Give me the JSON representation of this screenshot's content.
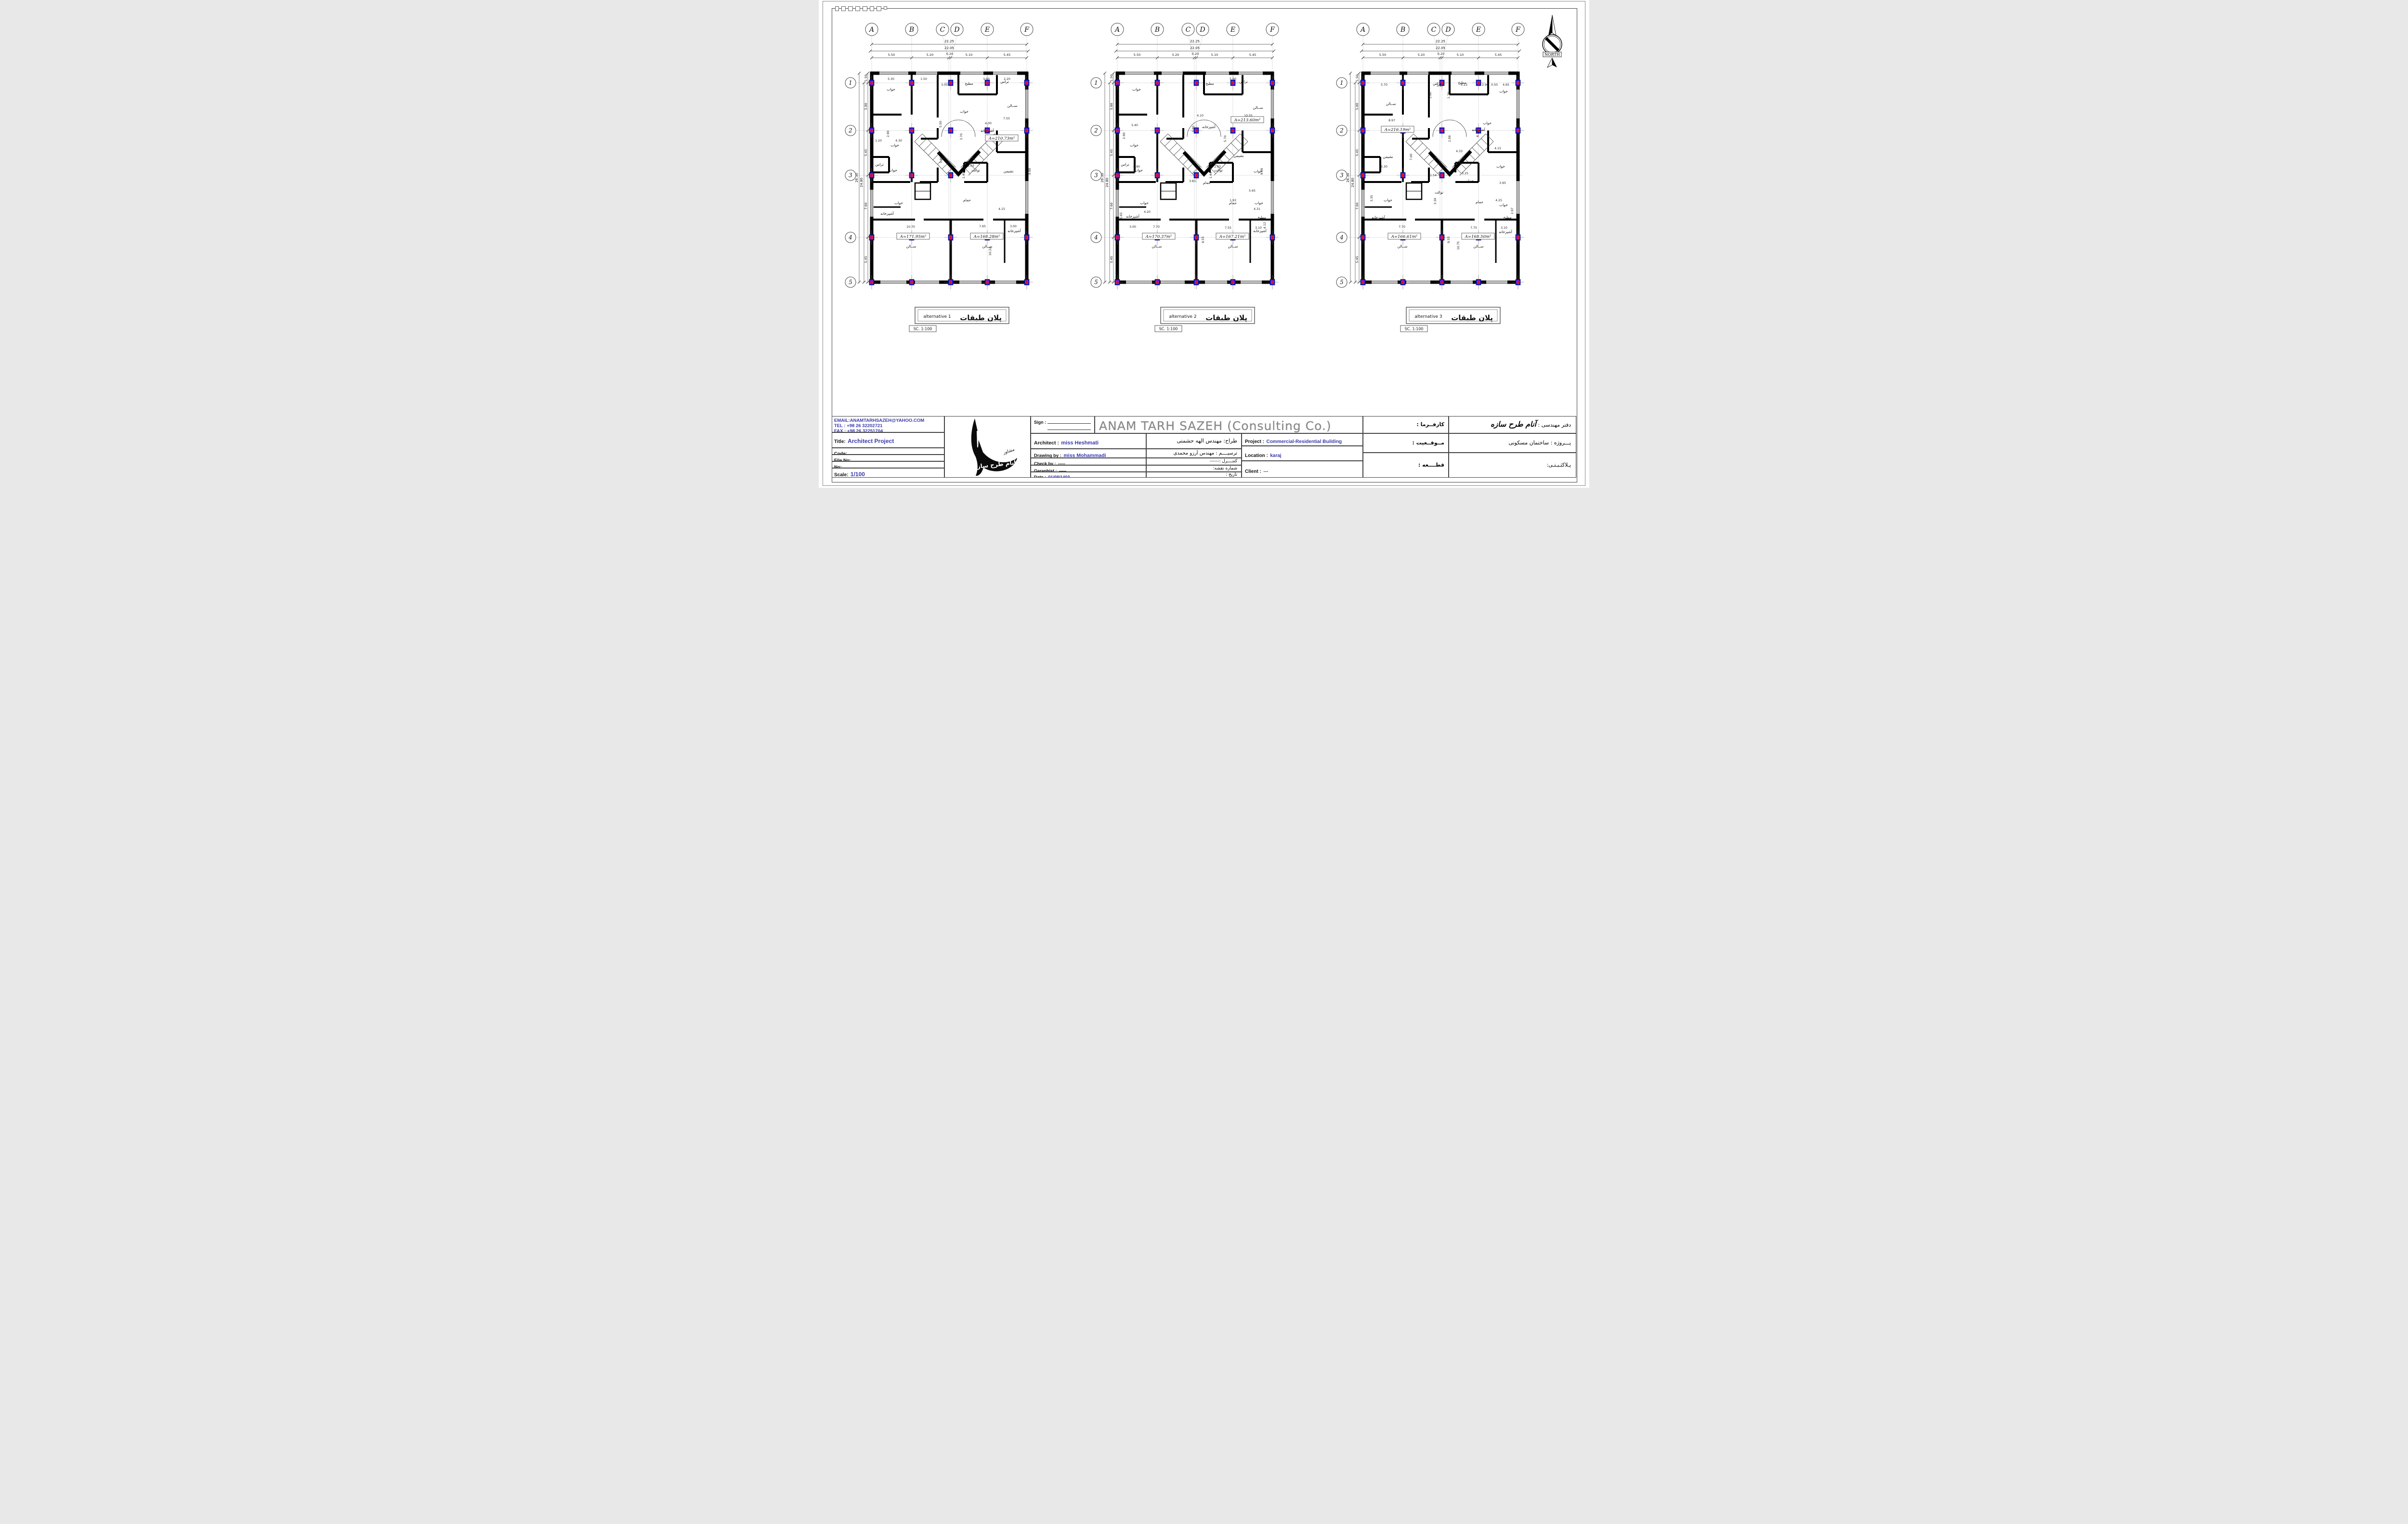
{
  "sheet": {
    "north_label": "NORTH"
  },
  "plan_shared": {
    "grid_cols": [
      "A",
      "B",
      "C",
      "D",
      "E",
      "F"
    ],
    "grid_rows": [
      "1",
      "2",
      "3",
      "4",
      "5"
    ],
    "top_dims": {
      "overall_outer": "22.25",
      "overall_inner": "22.05",
      "segments": [
        "5.50",
        "5.20",
        "0.20",
        "5.10",
        "5.45"
      ]
    },
    "left_dims": {
      "overall_outer": "26.30",
      "overall_inner": "24.80",
      "segments": [
        "1.50",
        "5.80",
        "5.45",
        "7.60",
        "5.45"
      ]
    }
  },
  "plans": [
    {
      "caption_en": "alternative 1",
      "caption_fa": "پلان طبقات",
      "scale_note": "SC.  1:100",
      "areas": [
        [
          330,
          264,
          "A=210.73m²"
        ],
        [
          146,
          468,
          "A=171.95m²"
        ],
        [
          299,
          468,
          "A=168.28m²"
        ]
      ],
      "rooms": [
        [
          100,
          162,
          "خواب"
        ],
        [
          252,
          208,
          "خواب"
        ],
        [
          262,
          150,
          "مطبخ"
        ],
        [
          336,
          146,
          "تراس"
        ],
        [
          352,
          196,
          "ســالن"
        ],
        [
          108,
          278,
          "خواب"
        ],
        [
          300,
          248,
          "آشپزخانه"
        ],
        [
          344,
          332,
          "نشیمن"
        ],
        [
          104,
          330,
          "خواب"
        ],
        [
          76,
          318,
          "تراس"
        ],
        [
          116,
          398,
          "خواب"
        ],
        [
          276,
          330,
          "توالت"
        ],
        [
          258,
          392,
          "حمام"
        ],
        [
          92,
          420,
          "آشپزخانه"
        ],
        [
          356,
          456,
          "آشپزخانه"
        ],
        [
          142,
          488,
          "ســالن"
        ],
        [
          300,
          488,
          "ســالن"
        ]
      ],
      "dims": [
        [
          100,
          140,
          "5.30"
        ],
        [
          168,
          140,
          "1.50"
        ],
        [
          211,
          152,
          "3.00"
        ],
        [
          298,
          140,
          "3.90"
        ],
        [
          341,
          140,
          "2.20"
        ],
        [
          340,
          222,
          "7.55"
        ],
        [
          302,
          232,
          "4.00"
        ],
        [
          205,
          232,
          "5.50",
          -90
        ],
        [
          248,
          258,
          "3.70",
          -90
        ],
        [
          116,
          268,
          "4.30"
        ],
        [
          74,
          268,
          "1.20"
        ],
        [
          206,
          306,
          "1.90",
          -90
        ],
        [
          266,
          320,
          "2.03"
        ],
        [
          253,
          338,
          "1.45",
          -90
        ],
        [
          141,
          447,
          "10.70"
        ],
        [
          290,
          446,
          "7.65"
        ],
        [
          354,
          446,
          "3.00"
        ],
        [
          308,
          496,
          "10.22",
          -90
        ],
        [
          390,
          330,
          "9.88",
          -90
        ],
        [
          330,
          410,
          "4.15"
        ],
        [
          96,
          252,
          "2.90",
          -90
        ]
      ]
    },
    {
      "caption_en": "alternative 2",
      "caption_fa": "پلان طبقات",
      "scale_note": "SC.  1:100",
      "areas": [
        [
          330,
          226,
          "A=213.60m²"
        ],
        [
          146,
          468,
          "A=170.37m²"
        ],
        [
          299,
          468,
          "A=167.21m²"
        ]
      ],
      "rooms": [
        [
          100,
          162,
          "خواب"
        ],
        [
          252,
          150,
          "مطبخ"
        ],
        [
          322,
          146,
          "تراس"
        ],
        [
          352,
          200,
          "ســالن"
        ],
        [
          250,
          240,
          "آشپزخانه"
        ],
        [
          312,
          300,
          "نشیمن"
        ],
        [
          95,
          278,
          "خواب"
        ],
        [
          104,
          330,
          "خواب"
        ],
        [
          76,
          318,
          "تراس"
        ],
        [
          116,
          398,
          "خواب"
        ],
        [
          270,
          330,
          "توالت"
        ],
        [
          246,
          356,
          "حمام"
        ],
        [
          300,
          398,
          "حمام"
        ],
        [
          352,
          332,
          "خواب"
        ],
        [
          354,
          398,
          "خواب"
        ],
        [
          92,
          426,
          "آشپزخانه"
        ],
        [
          356,
          456,
          "آشپزخانه"
        ],
        [
          360,
          428,
          "مطبخ"
        ],
        [
          142,
          488,
          "ســالن"
        ],
        [
          300,
          488,
          "ســالن"
        ]
      ],
      "dims": [
        [
          300,
          140,
          "5.60"
        ],
        [
          232,
          216,
          "4.10"
        ],
        [
          332,
          216,
          "10.55"
        ],
        [
          220,
          242,
          "3.80",
          -90
        ],
        [
          96,
          236,
          "5.40"
        ],
        [
          76,
          256,
          "2.90",
          -90
        ],
        [
          286,
          262,
          "5.70",
          -90
        ],
        [
          362,
          330,
          "9.88",
          -90
        ],
        [
          100,
          322,
          "4.90"
        ],
        [
          216,
          352,
          "3.81"
        ],
        [
          268,
          322,
          "2.03"
        ],
        [
          256,
          338,
          "1.44",
          -90
        ],
        [
          300,
          392,
          "1.93"
        ],
        [
          340,
          372,
          "5.65"
        ],
        [
          350,
          410,
          "4.31"
        ],
        [
          240,
          472,
          "8.55",
          -90
        ],
        [
          141,
          447,
          "7.70"
        ],
        [
          290,
          449,
          "7.55"
        ],
        [
          353,
          449,
          "3.10"
        ],
        [
          92,
          447,
          "3.00"
        ],
        [
          70,
          422,
          "5.65",
          -90
        ],
        [
          368,
          442,
          "4.12",
          -90
        ],
        [
          122,
          416,
          "4.20"
        ]
      ]
    },
    {
      "caption_en": "alternative 3",
      "caption_fa": "پلان طبقات",
      "scale_note": "SC.  1:100",
      "areas": [
        [
          132,
          246,
          "A=216.19m²"
        ],
        [
          146,
          468,
          "A=166.61m²"
        ],
        [
          299,
          468,
          "A=168.50m²"
        ]
      ],
      "rooms": [
        [
          118,
          192,
          "ســالن"
        ],
        [
          214,
          150,
          "تراس"
        ],
        [
          266,
          148,
          "مطبخ"
        ],
        [
          318,
          232,
          "خواب"
        ],
        [
          352,
          166,
          "خواب"
        ],
        [
          112,
          302,
          "نشیمن"
        ],
        [
          218,
          376,
          "توالت"
        ],
        [
          282,
          352,
          "حمام"
        ],
        [
          302,
          396,
          "حمام"
        ],
        [
          112,
          392,
          "خواب"
        ],
        [
          346,
          322,
          "خواب"
        ],
        [
          352,
          402,
          "خواب"
        ],
        [
          300,
          246,
          "آشپزخانه"
        ],
        [
          92,
          428,
          "آشپزخانه"
        ],
        [
          356,
          458,
          "آشپزخانه"
        ],
        [
          360,
          428,
          "مطبخ"
        ],
        [
          142,
          488,
          "ســالن"
        ],
        [
          300,
          488,
          "ســالن"
        ]
      ],
      "dims": [
        [
          104,
          152,
          "5.70"
        ],
        [
          202,
          172,
          "1.90",
          -90
        ],
        [
          220,
          154,
          "3.17"
        ],
        [
          240,
          172,
          "1.70",
          -90
        ],
        [
          270,
          152,
          "4.23"
        ],
        [
          314,
          152,
          "2.90"
        ],
        [
          333,
          152,
          "0.50"
        ],
        [
          357,
          152,
          "4.65"
        ],
        [
          120,
          226,
          "8.97"
        ],
        [
          162,
          300,
          "7.00",
          -90
        ],
        [
          260,
          290,
          "4.33"
        ],
        [
          242,
          262,
          "2.88",
          -90
        ],
        [
          300,
          252,
          "4.18",
          -90
        ],
        [
          340,
          284,
          "4.15"
        ],
        [
          104,
          322,
          "5.30"
        ],
        [
          206,
          340,
          "1.54"
        ],
        [
          212,
          392,
          "3.39",
          -90
        ],
        [
          272,
          336,
          "3.25"
        ],
        [
          350,
          356,
          "3.95"
        ],
        [
          342,
          392,
          "4.25"
        ],
        [
          372,
          412,
          "2.97",
          -90
        ],
        [
          80,
          386,
          "3.35",
          -90
        ],
        [
          141,
          447,
          "7.70"
        ],
        [
          290,
          449,
          "7.75"
        ],
        [
          353,
          449,
          "3.10"
        ],
        [
          240,
          472,
          "8.55",
          -90
        ],
        [
          260,
          484,
          "10.75",
          -90
        ]
      ]
    }
  ],
  "title_block": {
    "email": "EMAIL:ANAMTARHSAZEH@YAHOO.COM",
    "tel": "TEL : +98 26  32202721",
    "fax": "FAX : +98 26  32251704",
    "title_label": "Title:",
    "title_value": "Architect Project",
    "code_label": "Code:",
    "file_label": "File No:",
    "no_label": "No:",
    "scale_label": "Scale:",
    "scale_value": "1/100",
    "sign_label": "Sign :",
    "company_en": "ANAM TARH SAZEH (Consulting Co.)",
    "architect_label": "Architect :",
    "architect_value": "miss Heshmati",
    "drawing_label": "Drawing by :",
    "drawing_value": "miss Mohammadi",
    "check_label": "Check by :",
    "check_value": "-----",
    "geraphist_label": "Geraphist :",
    "geraphist_value": "-----",
    "date_label": "Date :",
    "date_value": "01/08/1403",
    "fa_tarrah": "طراح: مهندس الهه حشمتی",
    "fa_tarsim": "ترسیــــم : مهندس آرزو محمدی",
    "fa_control": "کنتــــرل :------",
    "fa_sheet_no": "شماره نقشه:",
    "fa_tarikh": "تاریخ :",
    "project_label": "Project :",
    "project_value": "Commercial-Residential Building",
    "location_label": "Location :",
    "location_value": "karaj",
    "client_label": "Client :",
    "client_value": "---",
    "fa_karfarma": "كارفــرما :",
    "fa_mowqeiat": "مــوقــعیت :",
    "fa_qateh": "قطــــعه :",
    "fa_daftar_label": "دفتر مهندسی :",
    "fa_daftar_value": "آنام طرح سازه",
    "fa_prozheh": "پـــروژه :  ساختمان مسکونی",
    "fa_pelak": "پـلاکثـبـتـی:",
    "fa_group": "گروه مهندسین مشاور"
  }
}
